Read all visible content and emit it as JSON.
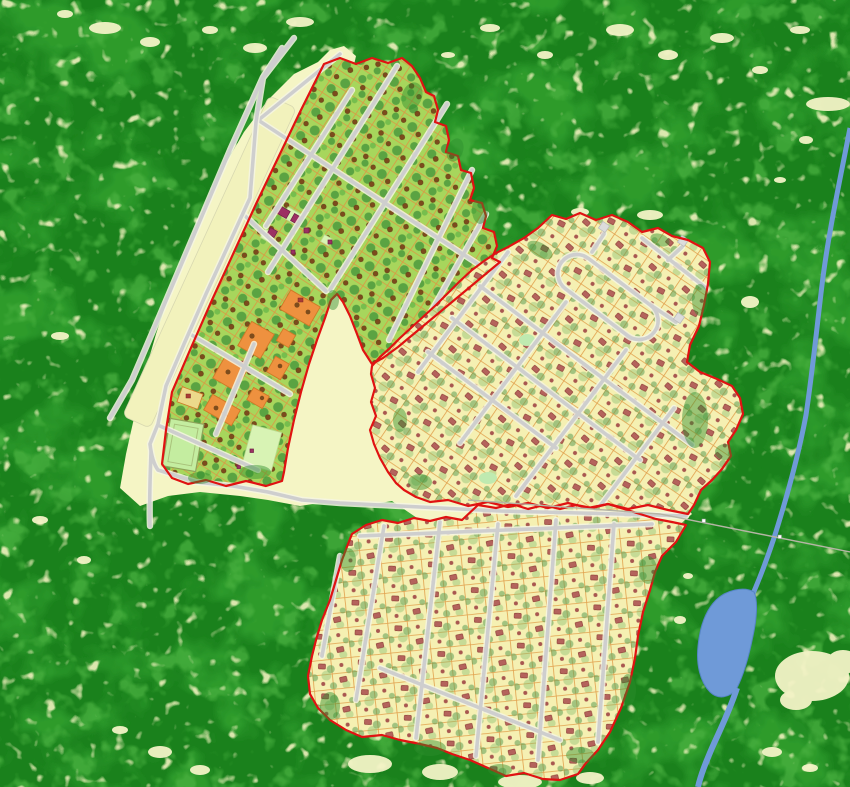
{
  "map": {
    "kind": "land-use-settlement-planning-map",
    "settlement_count": 3,
    "palette": {
      "forest_base": "#1a811c",
      "forest_mottle_mid": "#2d9b2c",
      "forest_mottle_light": "#4cb342",
      "forest_speckle": "#eff0bd",
      "clearing": "#f5f5c5",
      "airstrip": "#f2f2bc",
      "parcel_green": "#a7d65c",
      "parcel_cream": "#f5f0b2",
      "parcel_line": "#e1a04d",
      "orange_parcel": "#ee913f",
      "yellow_parcel": "#ecd98b",
      "mint_park": "#cdeebc",
      "sports_field": "#c4eda0",
      "canopy_green": "#47963c",
      "olive_vegetation": "#5f9e55",
      "tree_brown": "#7c4b1d",
      "house_red": "#b4635c",
      "house_red_outline": "#8c3a33",
      "community_building_purple": "#9c3063",
      "road_gray": "#cecece",
      "road_casing": "#f6f6e4",
      "boundary_red": "#e01212",
      "river_blue": "#6f9ad8",
      "river_edge_blue": "#5585c5",
      "power_line_gray": "#b5b5a5",
      "cul_de_sac_gray": "#dcdcdc"
    },
    "features": {
      "forest": {
        "label": "dense-forest-background"
      },
      "clearing": {
        "label": "cleared-land"
      },
      "airstrip": {
        "label": "airstrip-strip"
      },
      "river": {
        "label": "river"
      },
      "lake": {
        "label": "lake-widening"
      },
      "power_line": {
        "label": "power-line-east"
      },
      "settlements": [
        {
          "label": "northwest-green-parcel-settlement"
        },
        {
          "label": "east-cream-parcel-settlement-with-loop-road"
        },
        {
          "label": "south-cream-parcel-grid-settlement"
        }
      ]
    }
  }
}
